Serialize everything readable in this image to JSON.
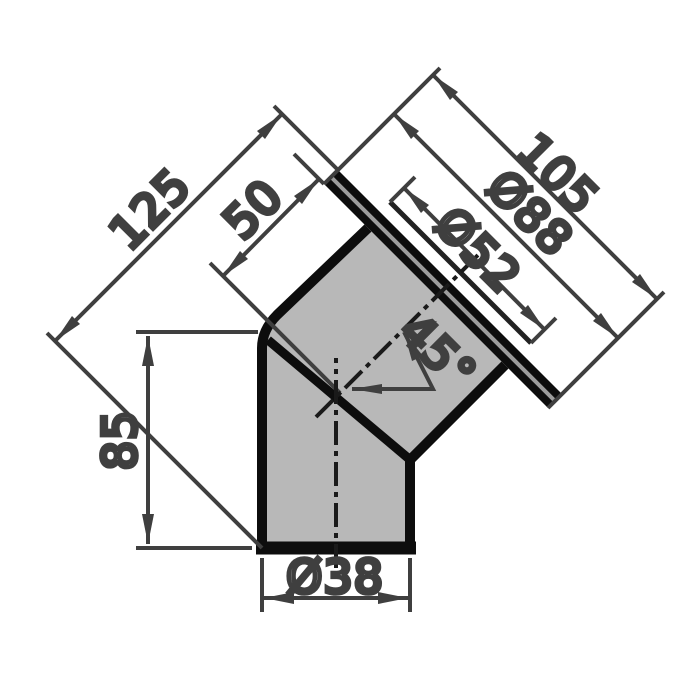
{
  "drawing": {
    "description": "Dimensioned technical drawing of a 45-degree elbow pipe fitting with socket flange",
    "labels": {
      "overall_length": "125",
      "center_to_flange": "50",
      "socket_length": "105",
      "flange_diameter": "Ø88",
      "socket_bore": "Ø52",
      "bend_angle": "45°",
      "leg_height": "85",
      "bottom_bore": "Ø38"
    },
    "colors": {
      "background": "#ffffff",
      "body_fill": "#b8b8b8",
      "outline": "#0d0d0d",
      "dimension_lines": "#3f3f3f",
      "centerline": "#1a1a1a",
      "flange_stripe": "#9c9c9c"
    }
  }
}
